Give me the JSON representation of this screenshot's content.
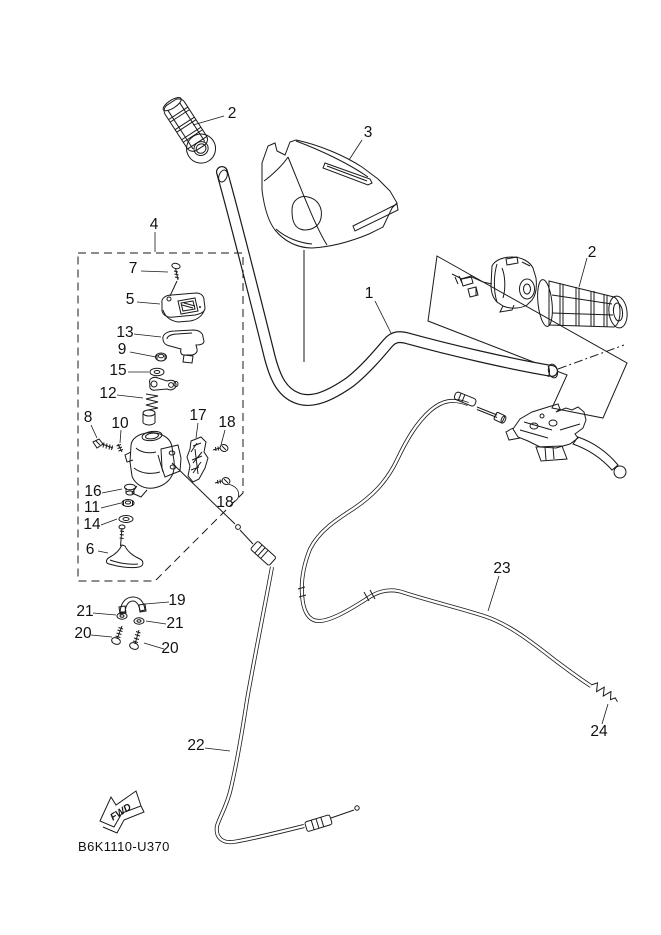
{
  "diagram": {
    "part_code": "B6K1110-U370",
    "fwd_label": "FWD",
    "line_color": "#1a1a1a",
    "background_color": "#ffffff"
  },
  "labels": {
    "p1": "1",
    "p2": "2",
    "p3": "3",
    "p4": "4",
    "p5": "5",
    "p6": "6",
    "p7": "7",
    "p8": "8",
    "p9": "9",
    "p10": "10",
    "p11": "11",
    "p12": "12",
    "p13": "13",
    "p14": "14",
    "p15": "15",
    "p16": "16",
    "p17": "17",
    "p18": "18",
    "p19": "19",
    "p20": "20",
    "p21": "21",
    "p22": "22",
    "p23": "23",
    "p24": "24"
  }
}
